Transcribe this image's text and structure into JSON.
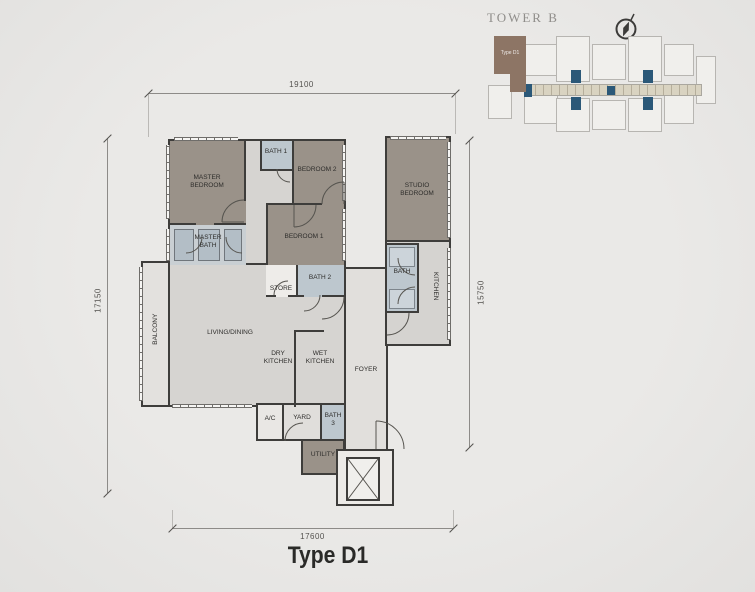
{
  "title": "Type D1",
  "tower_map": {
    "title": "TOWER B",
    "highlight_unit_label": "Type D1",
    "highlight_color": "#8d7565",
    "core_color": "#2b5878",
    "corridor_color": "#d9d3c1"
  },
  "dimensions": {
    "top": "19100",
    "left": "17150",
    "right": "15750",
    "bottom": "17600"
  },
  "rooms": {
    "master_bedroom": "MASTER BEDROOM",
    "master_bath": "MASTER BATH",
    "bath_1": "BATH 1",
    "bedroom_2": "BEDROOM 2",
    "bedroom_1": "BEDROOM 1",
    "store": "STORE",
    "bath_2": "BATH 2",
    "studio_bedroom": "STUDIO BEDROOM",
    "studio_bath": "BATH",
    "kitchen": "KITCHEN",
    "balcony": "BALCONY",
    "living_dining": "LIVING/DINING",
    "dry_kitchen": "DRY KITCHEN",
    "wet_kitchen": "WET KITCHEN",
    "foyer": "FOYER",
    "ac": "A/C",
    "yard": "YARD",
    "bath_3": "BATH 3",
    "utility": "UTILITY"
  },
  "colors": {
    "wall": "#3e3d3b",
    "floor": "#d6d4d1",
    "floor_light": "#e1dfdc",
    "room_dark": "#9a9289",
    "bath": "#bdc7ce",
    "bath_panel": "#b3bec6",
    "background": "#e9e8e6"
  }
}
